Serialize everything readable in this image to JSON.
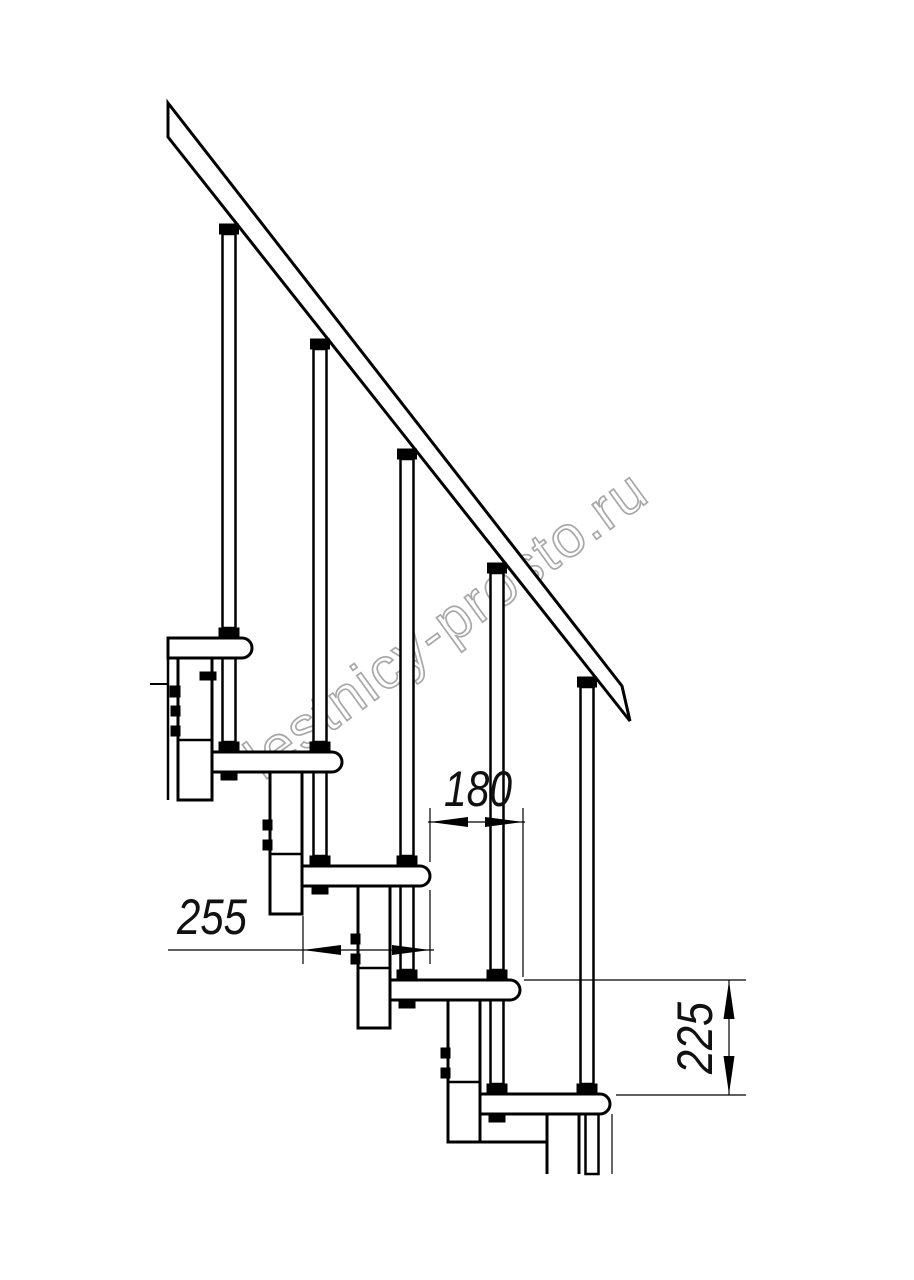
{
  "watermark": {
    "text": "lestnicy-prosto.ru"
  },
  "dimensions": {
    "step_offset": "180",
    "tread_depth": "255",
    "step_rise": "225"
  },
  "colors": {
    "line": "#000000",
    "watermark_outline": "#a8a8a8",
    "background": "#ffffff"
  }
}
